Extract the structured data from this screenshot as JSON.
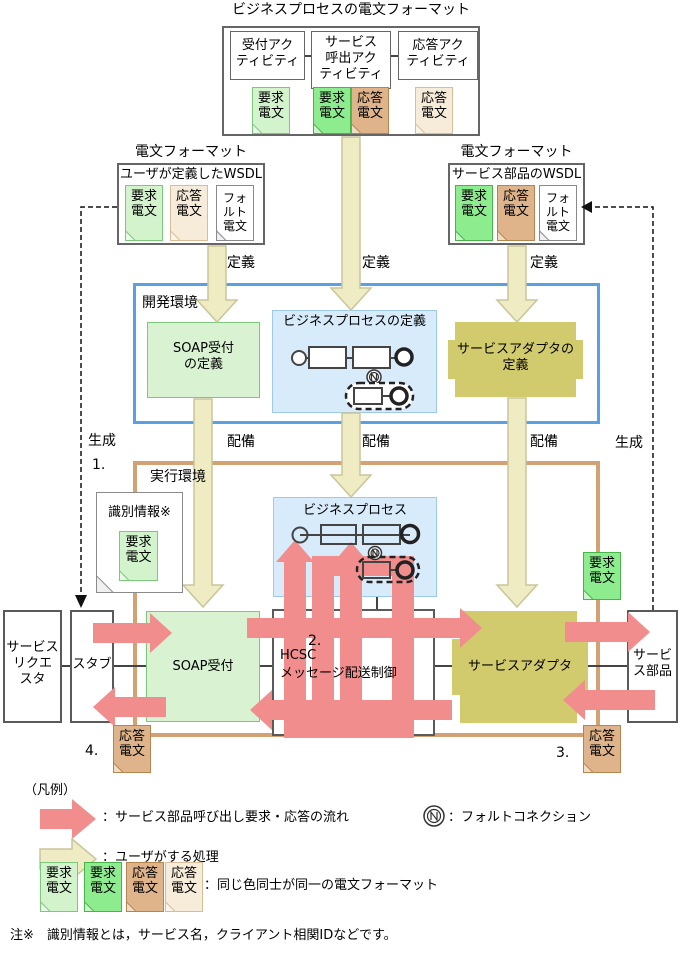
{
  "title": "ビジネスプロセスの電文フォーマット",
  "top_format": {
    "activities": [
      {
        "label": "受付アク\nティビティ"
      },
      {
        "label": "サービス\n呼出アク\nティビティ"
      },
      {
        "label": "応答アク\nティビティ"
      }
    ],
    "docs": [
      {
        "label": "要求\n電文"
      },
      {
        "label": "要求\n電文"
      },
      {
        "label": "応答\n電文"
      },
      {
        "label": "応答\n電文"
      }
    ]
  },
  "left_format": {
    "caption": "電文フォーマット",
    "heading": "ユーザが定義したWSDL",
    "docs": [
      {
        "label": "要求\n電文"
      },
      {
        "label": "応答\n電文"
      },
      {
        "label": "フォ\nルト\n電文"
      }
    ]
  },
  "right_format": {
    "caption": "電文フォーマット",
    "heading": "サービス部品のWSDL",
    "docs": [
      {
        "label": "要求\n電文"
      },
      {
        "label": "応答\n電文"
      },
      {
        "label": "フォ\nルト\n電文"
      }
    ]
  },
  "labels": {
    "define1": "定義",
    "define2": "定義",
    "define3": "定義",
    "deploy1": "配備",
    "deploy2": "配備",
    "deploy3": "配備",
    "generate_left": "生成",
    "generate_right": "生成",
    "step1": "1.",
    "step2": "2.",
    "step3": "3.",
    "step4": "4."
  },
  "dev_env": {
    "title": "開発環境",
    "soap_def": "SOAP受付\nの定義",
    "bp_def_title": "ビジネスプロセスの定義",
    "adapter_def": "サービスアダプタの\n定義"
  },
  "run_env": {
    "title": "実行環境",
    "bp_title": "ビジネスプロセス",
    "requester": "サービス\nリクエ\nスタ",
    "stub": "スタブ",
    "soap": "SOAP受付",
    "hcsc": "HCSC\nメッセージ配送制御",
    "adapter": "サービスアダプタ",
    "component": "サービ\nス部品",
    "id_doc_title": "識別情報※",
    "id_doc_request": "要求\n電文",
    "request_doc_right": "要求\n電文",
    "response_doc_left": "応答\n電文",
    "response_doc_right": "応答\n電文"
  },
  "legend": {
    "caption": "（凡例）",
    "flow_label": "：サービス部品呼び出し要求・応答の流れ",
    "fault_label": "：フォルトコネクション",
    "user_label": "：ユーザがする処理",
    "format_label": "：同じ色同士が同一の電文フォーマット",
    "docs": [
      {
        "label": "要求\n電文"
      },
      {
        "label": "要求\n電文"
      },
      {
        "label": "応答\n電文"
      },
      {
        "label": "応答\n電文"
      }
    ]
  },
  "note": "注※　識別情報とは，サービス名，クライアント相関IDなどです。",
  "colors": {
    "flow_arrow": "#f18d8d",
    "user_arrow": "#efecc3",
    "doc_green_light": "#d2f3cc",
    "doc_green": "#8dec8d",
    "doc_tan_dark": "#dfb48a",
    "doc_tan_light": "#f7ecda",
    "dev_border": "#59a1e3",
    "run_border": "#d3a272",
    "adapter_fill": "#d1cb6d",
    "bp_fill": "#d8ebfa",
    "soap_fill": "#d8f2d2"
  }
}
